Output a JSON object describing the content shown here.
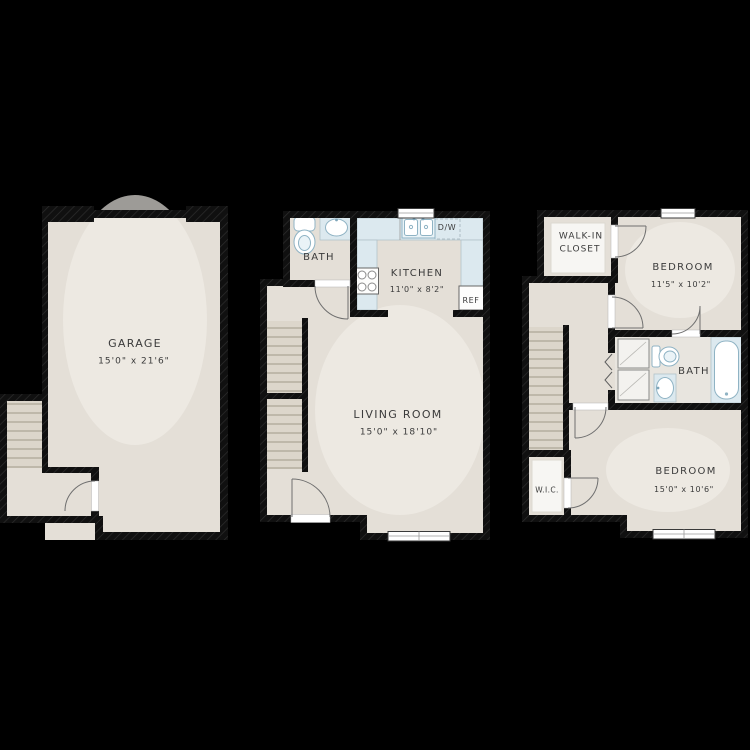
{
  "document": {
    "type": "apartment-floor-plan",
    "background": "#000000"
  },
  "colors": {
    "background": "#000000",
    "wall": "#121212",
    "floor": "#e4dfd7",
    "counter": "#dce9ef",
    "fixture_outline": "#8fb3c4",
    "text": "#3b3b3b"
  },
  "garage_plan": {
    "room_label": "GARAGE",
    "room_dims": "15'0\" x 21'6\""
  },
  "main_floor_plan": {
    "bath_label": "BATH",
    "kitchen_label": "KITCHEN",
    "kitchen_dims": "11'0\" x 8'2\"",
    "dishwasher_label": "D/W",
    "fridge_label": "REF",
    "living_label": "LIVING ROOM",
    "living_dims": "15'0\" x 18'10\""
  },
  "upper_floor_plan": {
    "walk_in_line1": "WALK-IN",
    "walk_in_line2": "CLOSET",
    "bedroom1_label": "BEDROOM",
    "bedroom1_dims": "11'5\" x 10'2\"",
    "bath_label": "BATH",
    "wic_label": "W.I.C.",
    "bedroom2_label": "BEDROOM",
    "bedroom2_dims": "15'0\" x 10'6\""
  }
}
